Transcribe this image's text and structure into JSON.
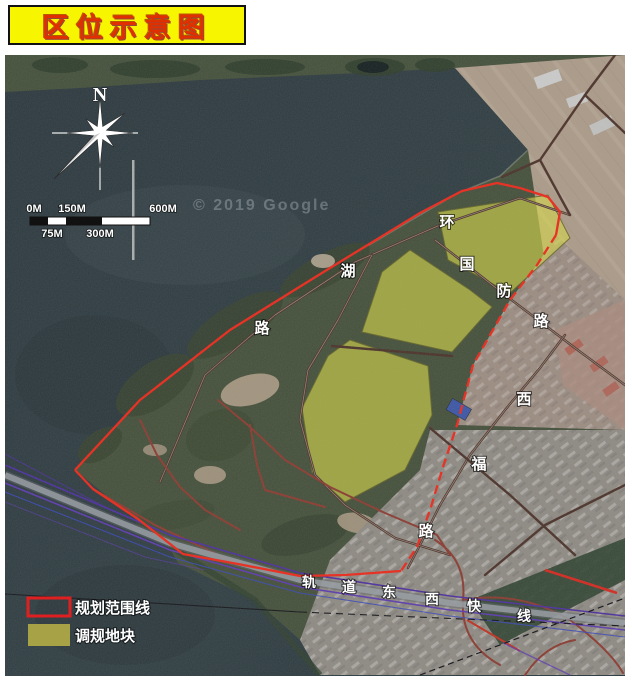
{
  "title": {
    "text": "区位示意图"
  },
  "map": {
    "watermark": "© 2019 Google",
    "compass_north": "N",
    "scale_bar": {
      "top": [
        "0M",
        "150M",
        "600M"
      ],
      "bottom": [
        "75M",
        "300M"
      ]
    },
    "road_names": {
      "huanhu": [
        "环",
        "湖",
        "路"
      ],
      "guofang": [
        "国",
        "防",
        "路"
      ],
      "xifu": [
        "西",
        "福",
        "路"
      ],
      "rail_line": [
        "轨",
        "道",
        "东",
        "西",
        "快",
        "线"
      ]
    },
    "legend": [
      {
        "label": "规划范围线",
        "swatch": "red-outline"
      },
      {
        "label": "调规地块",
        "swatch": "olive-fill"
      }
    ],
    "colors": {
      "boundary_red": "#e63326",
      "plot_yellow": "#d6d846",
      "legend_olive": "#a8a246",
      "banner_yellow": "#f8f501",
      "banner_text_red": "#e03000",
      "rail_purple": "#4b2f9e",
      "water": "#2d3b40",
      "land_green": "#434f3a"
    }
  }
}
